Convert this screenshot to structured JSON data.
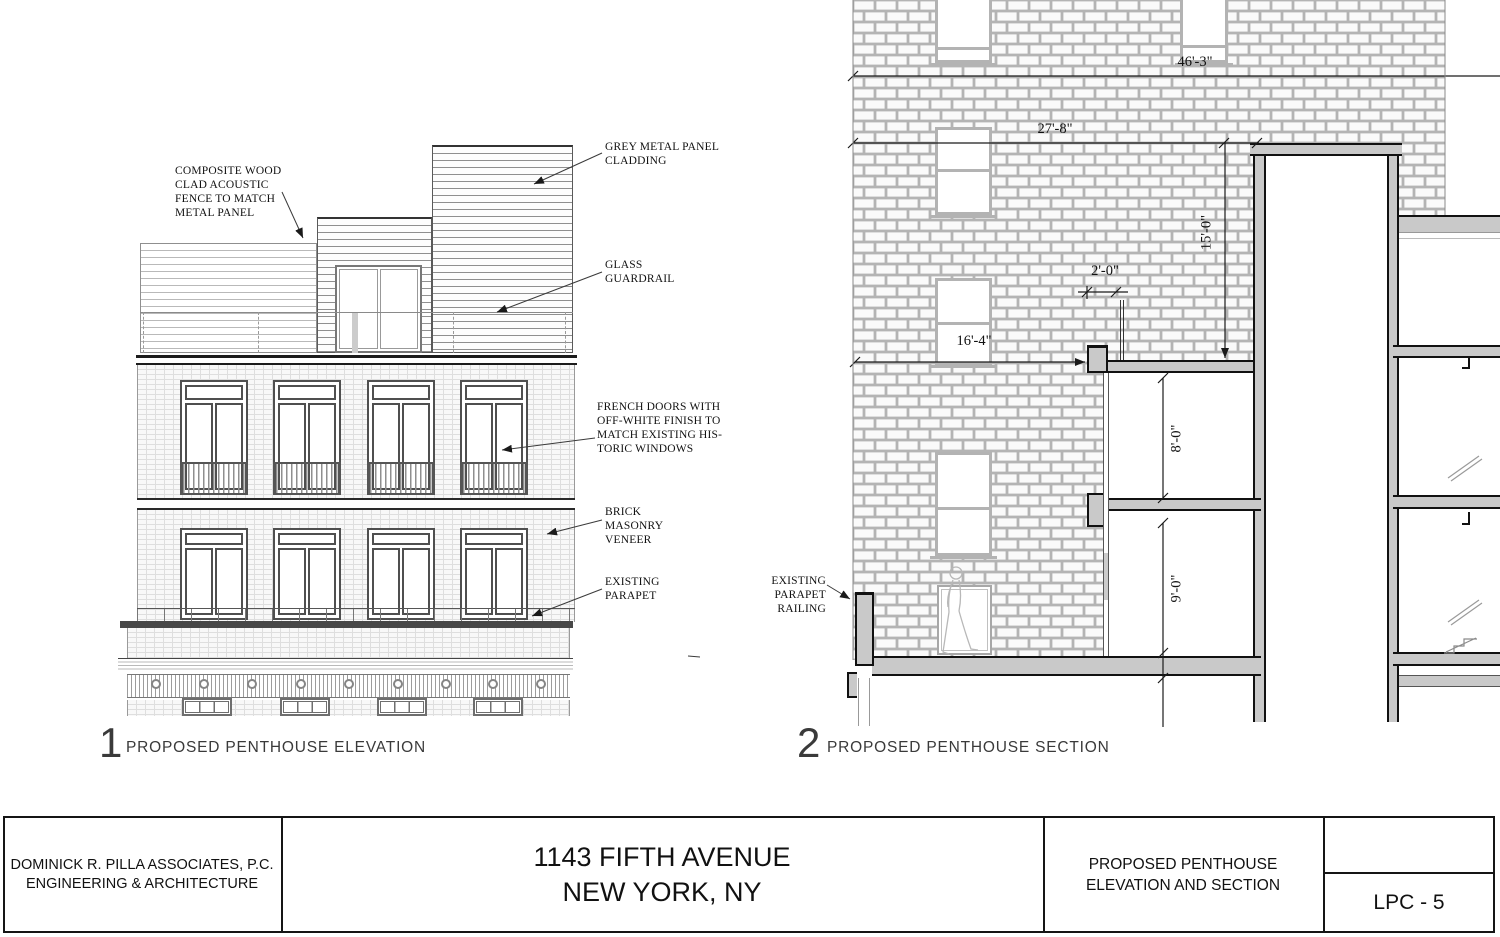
{
  "titleblock": {
    "firm_line1": "DOMINICK R. PILLA ASSOCIATES, P.C.",
    "firm_line2": "ENGINEERING & ARCHITECTURE",
    "project_line1": "1143 FIFTH AVENUE",
    "project_line2": "NEW YORK, NY",
    "sheet_title_line1": "PROPOSED PENTHOUSE",
    "sheet_title_line2": "ELEVATION AND SECTION",
    "sheet_number": "LPC - 5"
  },
  "elevation": {
    "number": "1",
    "caption": "PROPOSED PENTHOUSE ELEVATION",
    "annotations": {
      "acoustic_fence": "COMPOSITE WOOD\nCLAD ACOUSTIC\nFENCE TO MATCH\nMETAL PANEL",
      "metal_panel": "GREY METAL PANEL\nCLADDING",
      "glass_guardrail": "GLASS\nGUARDRAIL",
      "french_doors": "FRENCH DOORS WITH\nOFF-WHITE FINISH TO\nMATCH EXISTING HIS-\nTORIC WINDOWS",
      "brick_veneer": "BRICK\nMASONRY\nVENEER",
      "existing_parapet": "EXISTING\nPARAPET"
    }
  },
  "section": {
    "number": "2",
    "caption": "PROPOSED PENTHOUSE SECTION",
    "annotations": {
      "existing_parapet_railing": "EXISTING\nPARAPET\nRAILING"
    },
    "dimensions": {
      "overall_width": "46'-3\"",
      "upper_width": "27'-8\"",
      "penthouse_height": "15'-0\"",
      "railing_offset": "2'-0\"",
      "terrace_width": "16'-4\"",
      "upper_room_height": "8'-0\"",
      "lower_room_height": "9'-0\""
    }
  },
  "colors": {
    "line": "#1a1a1a",
    "poche": "#c9c9c9",
    "brick_joint": "#b4b4b4",
    "light_frame": "#b3b3b3"
  }
}
